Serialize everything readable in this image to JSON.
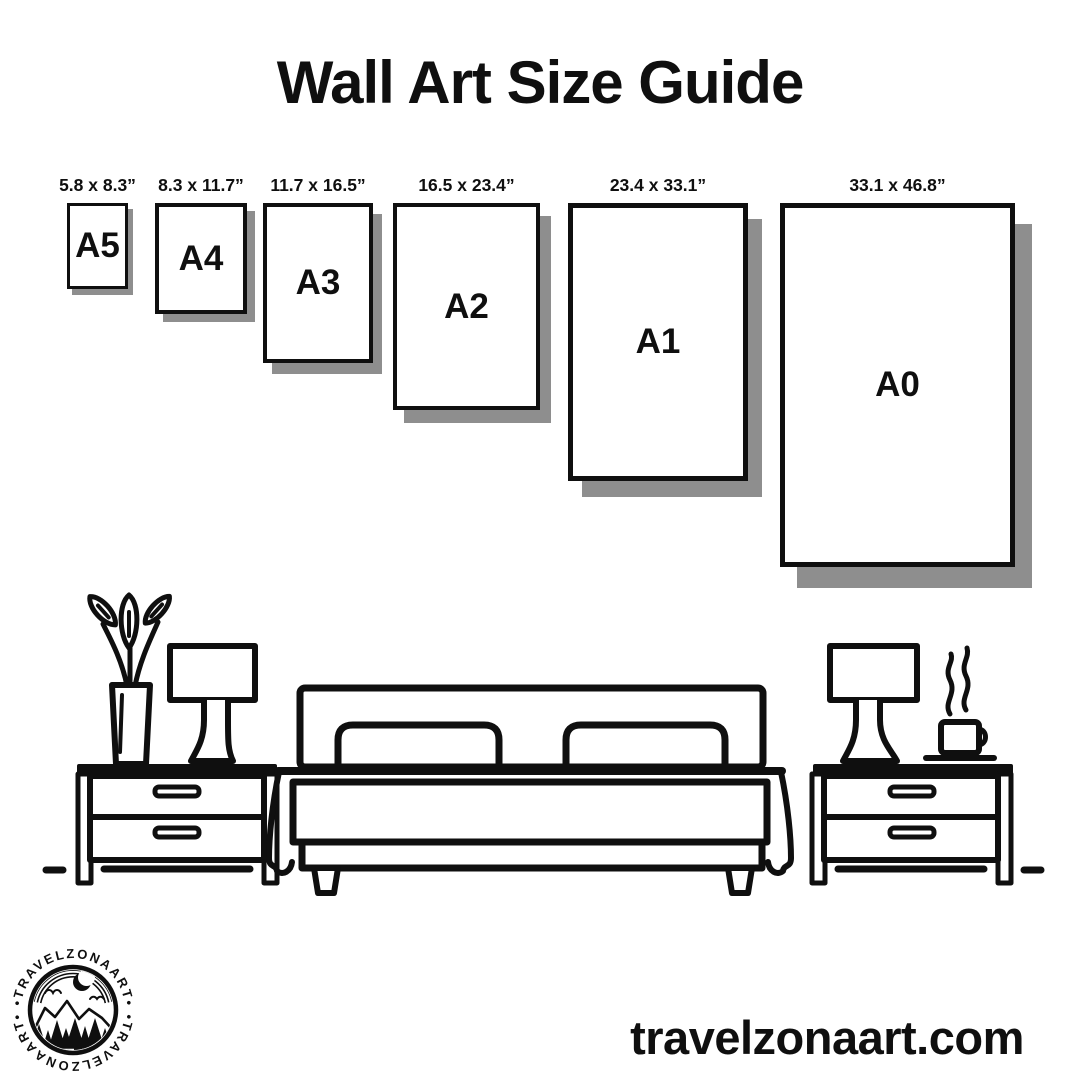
{
  "title": "Wall Art Size Guide",
  "sizes": [
    {
      "code": "A5",
      "dimensions": "5.8 x 8.3”"
    },
    {
      "code": "A4",
      "dimensions": "8.3 x 11.7”"
    },
    {
      "code": "A3",
      "dimensions": "11.7 x 16.5”"
    },
    {
      "code": "A2",
      "dimensions": "16.5 x 23.4”"
    },
    {
      "code": "A1",
      "dimensions": "23.4 x 33.1”"
    },
    {
      "code": "A0",
      "dimensions": "33.1 x 46.8”"
    }
  ],
  "logo": {
    "arc_text_top": "•TRAVELZONAART•",
    "arc_text_bottom": "•TRAVELZONAART•"
  },
  "footer": {
    "website": "travelzonaart.com"
  },
  "colors": {
    "ink": "#0f0f0f",
    "shadow": "#8e8e8e",
    "background": "#ffffff"
  }
}
